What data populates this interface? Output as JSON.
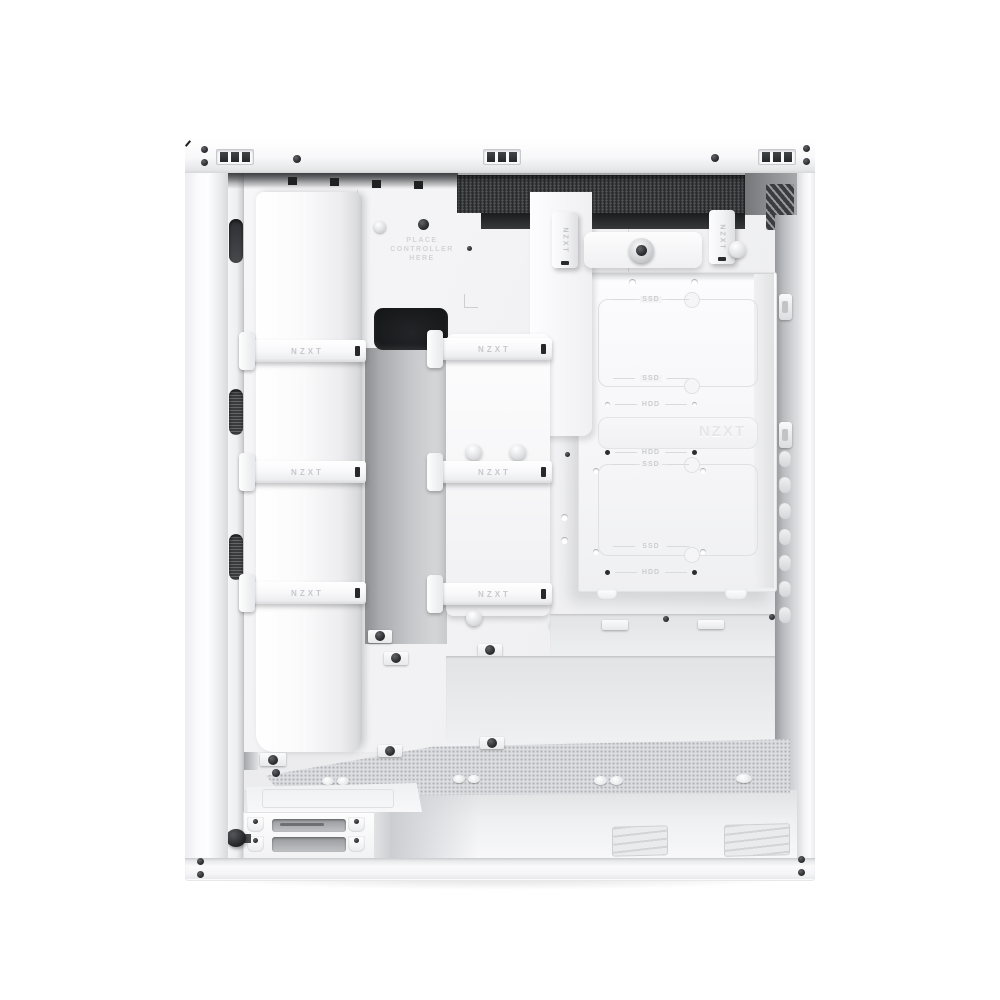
{
  "image": {
    "type": "product-photo",
    "subject": "White NZXT mid-tower PC case, cable-management side view with side panel removed",
    "background_color": "#ffffff"
  },
  "texts": {
    "strap_label": "NZXT",
    "controller_area": {
      "line1": "PLACE",
      "line2": "CONTROLLER",
      "line3": "HERE"
    },
    "drive_tray_logo": "NZXT",
    "drive_slot_labels": [
      "SSD",
      "SSD",
      "HDD",
      "HDD",
      "SSD",
      "SSD",
      "HDD"
    ]
  },
  "features": {
    "velcro_straps_horizontal": 6,
    "velcro_straps_vertical": 2,
    "top_vent_groups": 3,
    "right_edge_vent_slots": 7,
    "psu_bracket_slots": 2,
    "front_wall_vent_ovals": 3
  },
  "colors": {
    "case_white": "#fafafb",
    "panel_light": "#f2f2f4",
    "recess_gray": "#c5c6c9",
    "vent_dark": "#28292b",
    "engraving_gray": "#d2d3d6"
  }
}
